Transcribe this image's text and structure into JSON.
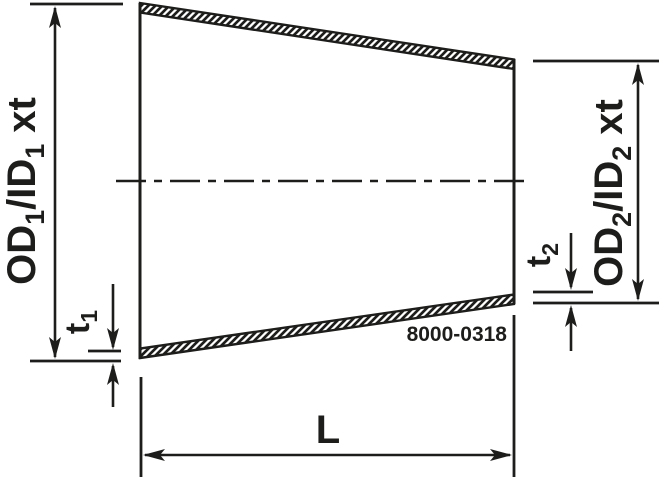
{
  "colors": {
    "ink": "#1d1d1b",
    "background": "#ffffff"
  },
  "drawing": {
    "number": "8000-0318",
    "dimensions": {
      "large_end_diameter": {
        "text": "OD₁/ID₁ xt",
        "prefix": "OD",
        "sub_a": "1",
        "mid": "/ID",
        "sub_b": "1",
        "suffix": "xt"
      },
      "small_end_diameter": {
        "text": "OD₂/ID₂ xt",
        "prefix": "OD",
        "sub_a": "2",
        "mid": "/ID",
        "sub_b": "2",
        "suffix": "xt"
      },
      "wall_thickness_large_end": {
        "text": "t₁",
        "prefix": "t",
        "sub": "1"
      },
      "wall_thickness_small_end": {
        "text": "t₂",
        "prefix": "t",
        "sub": "2"
      },
      "length": {
        "text": "L"
      }
    }
  }
}
